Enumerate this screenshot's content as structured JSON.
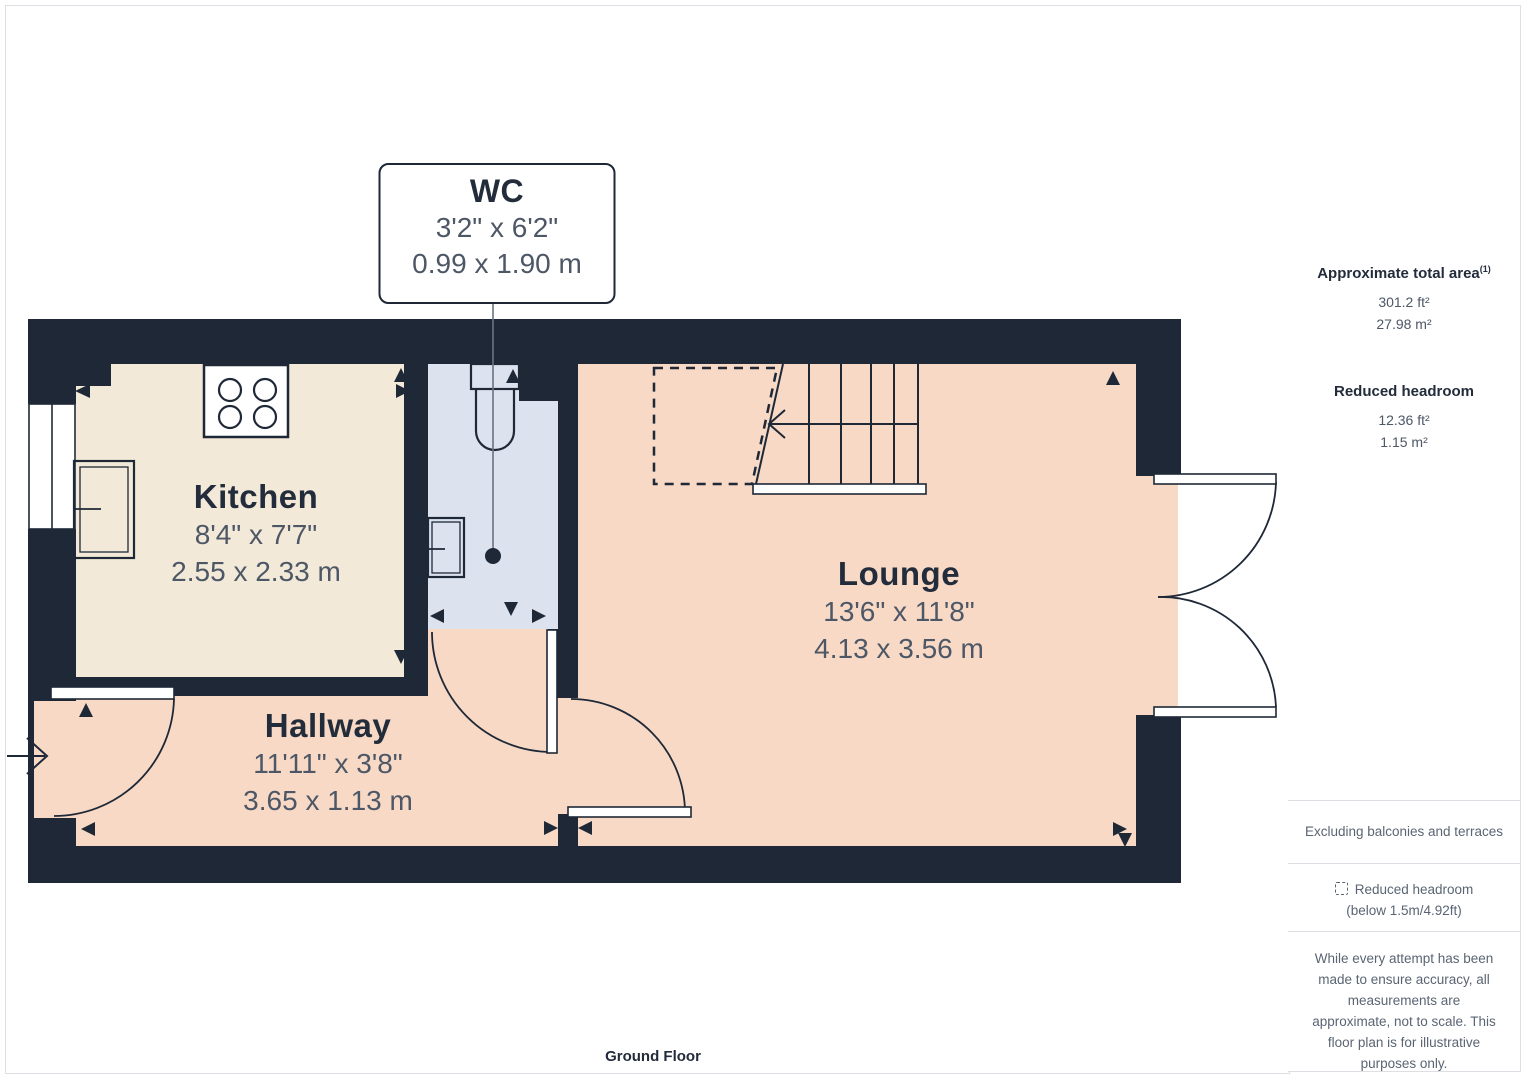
{
  "colors": {
    "wall": "#1e2836",
    "kitchen_floor": "#f2e9d8",
    "warm_floor": "#f7d9c6",
    "wc_floor": "#dce2ee",
    "room_name_text": "#232c3b",
    "dimension_text": "#4d5766",
    "sidebar_text": "#5a6573",
    "leader_line": "#6b7280",
    "panel_border": "#dcdfe4"
  },
  "rooms": {
    "kitchen": {
      "name": "Kitchen",
      "imperial": "8'4\" x 7'7\"",
      "metric": "2.55 x 2.33 m"
    },
    "hallway": {
      "name": "Hallway",
      "imperial": "11'11\" x 3'8\"",
      "metric": "3.65 x 1.13 m"
    },
    "lounge": {
      "name": "Lounge",
      "imperial": "13'6\" x 11'8\"",
      "metric": "4.13 x 3.56 m"
    },
    "wc": {
      "name": "WC",
      "imperial": "3'2\" x 6'2\"",
      "metric": "0.99 x 1.90 m"
    }
  },
  "floor_label": "Ground Floor",
  "sidebar": {
    "approx_area_label": "Approximate total area",
    "approx_area_sup": "(1)",
    "approx_area_ft": "301.2 ft²",
    "approx_area_m": "27.98 m²",
    "reduced_headroom_label": "Reduced headroom",
    "reduced_headroom_ft": "12.36 ft²",
    "reduced_headroom_m": "1.15 m²",
    "excluding_note": "Excluding balconies and terraces",
    "legend_label": "Reduced headroom",
    "legend_sub": "(below 1.5m/4.92ft)",
    "disclaimer": "While every attempt has been made to ensure accuracy, all measurements are approximate, not to scale. This floor plan is for illustrative purposes only.",
    "brand_name": "GIRAFFE",
    "brand_suffix": "360"
  }
}
